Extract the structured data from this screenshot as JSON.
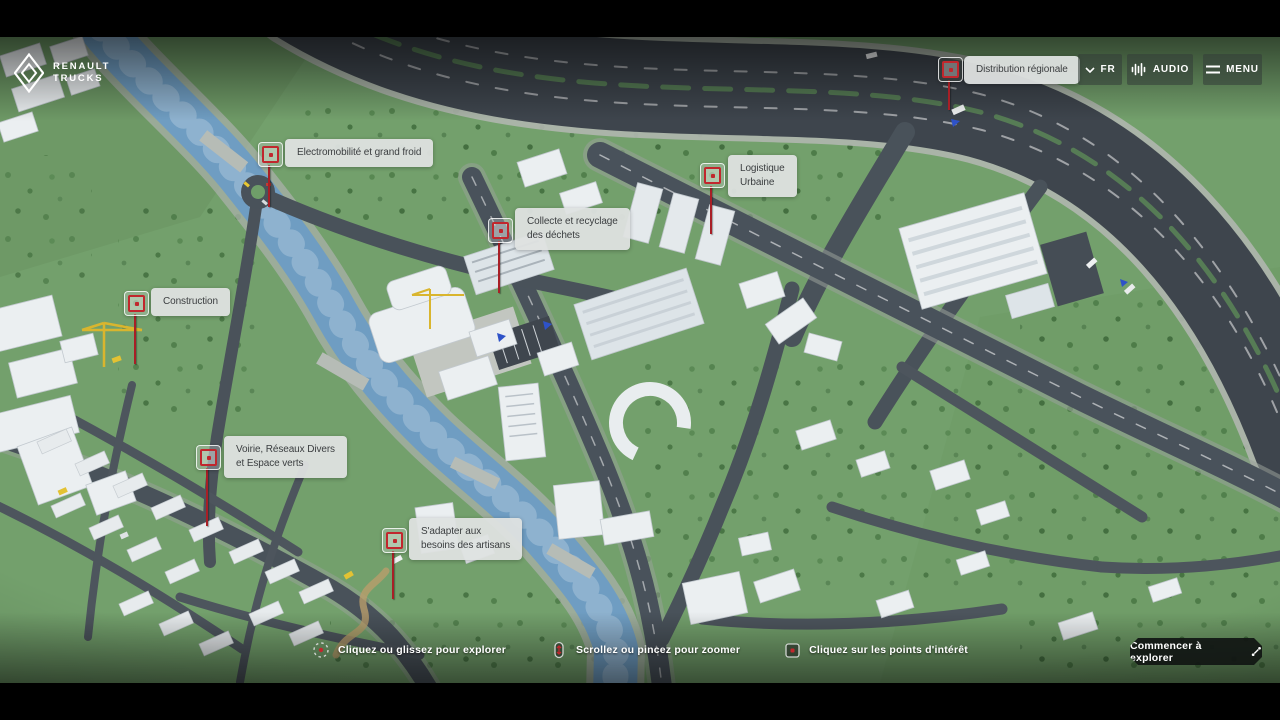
{
  "brand": {
    "name": "Renault Trucks",
    "line1": "RENAULT",
    "line2": "TRUCKS"
  },
  "header": {
    "language_button": {
      "label": "FR",
      "icon": "chevron-down-icon"
    },
    "audio_button": {
      "label": "AUDIO",
      "icon": "audio-wave-icon"
    },
    "menu_button": {
      "label": "MENU",
      "icon": "hamburger-icon"
    }
  },
  "pois": [
    {
      "id": "distribution-regionale",
      "lines": [
        "Distribution régionale"
      ]
    },
    {
      "id": "electromobilite-grand-froid",
      "lines": [
        "Electromobilité et grand froid"
      ]
    },
    {
      "id": "collecte-recyclage-dechets",
      "lines": [
        "Collecte et recyclage",
        "des déchets"
      ]
    },
    {
      "id": "logistique-urbaine",
      "lines": [
        "Logistique",
        "Urbaine"
      ]
    },
    {
      "id": "construction",
      "lines": [
        "Construction"
      ]
    },
    {
      "id": "voirie-reseaux-espaces-verts",
      "lines": [
        "Voirie, Réseaux Divers",
        "et Espace verts"
      ]
    },
    {
      "id": "adapter-besoins-artisans",
      "lines": [
        "S'adapter aux",
        "besoins des artisans"
      ]
    }
  ],
  "footer": {
    "hints": [
      {
        "icon": "drag-explore-icon",
        "text": "Cliquez ou glissez pour explorer"
      },
      {
        "icon": "scroll-zoom-icon",
        "text": "Scrollez ou pincez pour zoomer"
      },
      {
        "icon": "poi-click-icon",
        "text": "Cliquez sur les points d'intérêt"
      }
    ],
    "cta_label": "Commencer à explorer"
  },
  "colors": {
    "accent_red": "#c1272d",
    "label_bg": "#dee1e0",
    "label_text": "#3b3e40",
    "header_button_bg": "rgba(52,62,56,0.58)",
    "cta_bg": "#111513",
    "grass": "#73a06c",
    "road": "#49525a",
    "river": "#6f9dc2",
    "building": "#ebeff1"
  }
}
